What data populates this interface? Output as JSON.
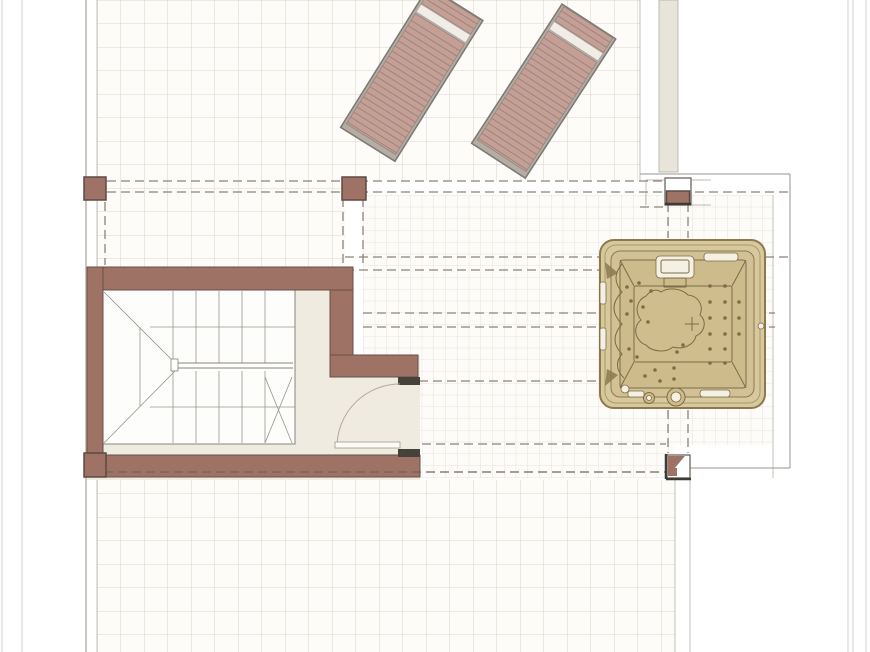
{
  "page": {
    "title": "Roof terrace floor plan",
    "drawing_type": "architectural plan view, no text labels visible"
  },
  "colors": {
    "paper": "#ffffff",
    "tileBg": "#fdfcf9",
    "tileLine": "#b4a895",
    "fineLine": "#bfb3a0",
    "marginLine": "#d5d0c8",
    "edge": "#9a958c",
    "dash": "#8a8478",
    "wall": "#9e7366",
    "wallDark": "#6a4f45",
    "cap": "#46413b",
    "cream": "#efebe0",
    "loungerFrame": "#b5aca4",
    "loungerSlat": "#c79e93",
    "loungerLine": "#8d8780",
    "loungerHead": "#f1ece6",
    "tubOuter": "#d8c89e",
    "tubMid": "#d2c194",
    "tubBasin": "#cdbb8c",
    "tubFloor": "#cfbd8e",
    "tubLine": "#7c6d45",
    "tubDark": "#8a7a4e",
    "tubWhite": "#f4f0e4",
    "wallstrip": "#e8e4da"
  },
  "elements": {
    "terrace": {
      "coarse_tile_regions": 3,
      "fine_tile_regions": 2,
      "description": "large tiled roof terrace with coarse square paving; finer paving band around hot tub zone"
    },
    "sun_loungers": {
      "count": 2,
      "style": "slatted loungers with light headrest band, rotated about 32 degrees"
    },
    "stairwell": {
      "walls": "L-shaped sienna masonry",
      "stair": "switchback flight with winders, central handrail, door opening at lower right with swing arc"
    },
    "hot_tub": {
      "shape": "rounded square spa with inner basin, molded seat, jets, headrest pillow, drains"
    },
    "pillars": {
      "count": 4,
      "description": "small square posts at overhang corners"
    },
    "dashed_lines": "overhead pergola / roof edge projection lines"
  }
}
